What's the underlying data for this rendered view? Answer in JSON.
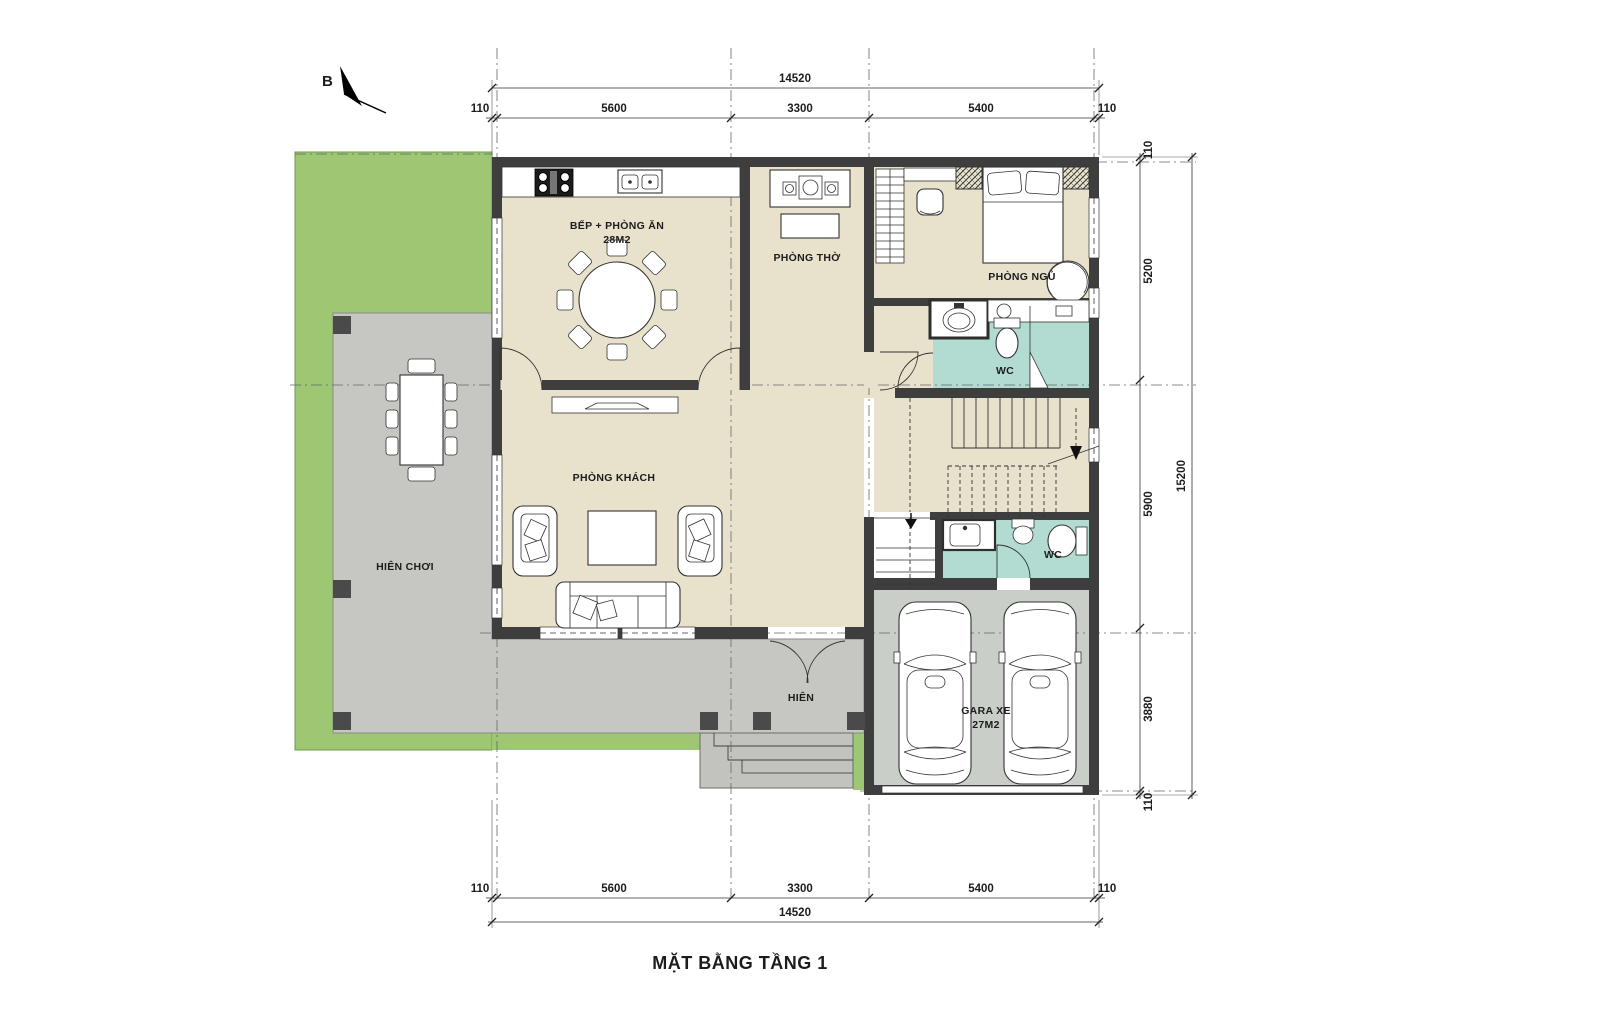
{
  "title": "MẶT BẰNG TẦNG 1",
  "north": {
    "label": "B"
  },
  "rooms": {
    "kitchen": {
      "label": "BẾP + PHÒNG ĂN",
      "area": "28M2"
    },
    "worship": {
      "label": "PHÒNG THỜ"
    },
    "bedroom": {
      "label": "PHÒNG NGỦ"
    },
    "wc1": {
      "label": "WC"
    },
    "wc2": {
      "label": "WC"
    },
    "living": {
      "label": "PHÒNG KHÁCH"
    },
    "playPorch": {
      "label": "HIÊN CHƠI"
    },
    "porch": {
      "label": "HIÊN"
    },
    "garage": {
      "label": "GARA XE",
      "area": "27M2"
    }
  },
  "dims": {
    "h": {
      "total": "14520",
      "s0": "110",
      "s1": "5600",
      "s2": "3300",
      "s3": "5400",
      "s4": "110"
    },
    "v": {
      "total": "15200",
      "s0": "110",
      "s1": "5200",
      "s2": "5900",
      "s3": "3880",
      "s4": "110"
    }
  },
  "colors": {
    "lawn": "#9dc772",
    "paving": "#c6c7c2",
    "floor": "#e8e2cc",
    "wetFloor": "#b2dcd2",
    "garageFloor": "#c9cec8",
    "wall": "#3e3e3e"
  }
}
